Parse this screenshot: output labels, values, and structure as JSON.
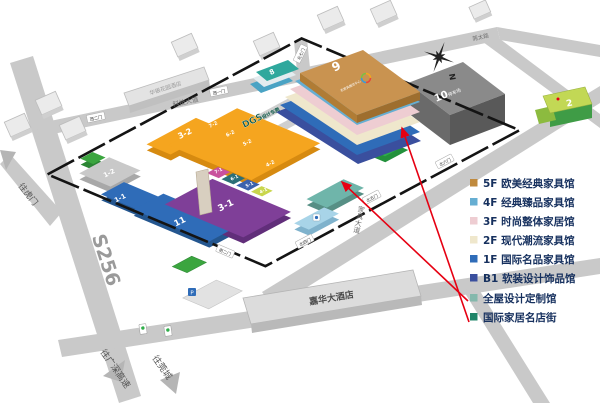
{
  "legend": {
    "items": [
      {
        "label": "5F 欧美经典家具馆",
        "color": "#c08a3e"
      },
      {
        "label": "4F 经典臻品家具馆",
        "color": "#66aed2"
      },
      {
        "label": "3F 时尚整体家居馆",
        "color": "#eecdd2"
      },
      {
        "label": "2F 现代潮流家具馆",
        "color": "#efe7cc"
      },
      {
        "label": "1F 国际名品家具馆",
        "color": "#2f6cb8"
      },
      {
        "label": "B1 软装设计饰品馆",
        "color": "#3a4f9e"
      },
      {
        "label": "全屋设计定制馆",
        "color": "#84b8ac"
      },
      {
        "label": "国际家居名店街",
        "color": "#1f8468"
      }
    ]
  },
  "roads": {
    "s256": "S256",
    "top_road": "科技大道",
    "top_right_road": "莞太路",
    "furniture_avenue": "家具大道"
  },
  "directions": {
    "to_humen": "往虎门",
    "to_expressway": "往广深高速",
    "to_guancheng": "往莞城"
  },
  "gates": {
    "west2": "西二门",
    "west1": "西一门",
    "north7": "北七门",
    "north6": "北六门",
    "north5": "北五门",
    "north4": "北四门",
    "south2": "南二门"
  },
  "compass": {
    "north": "N"
  },
  "buildings": {
    "b9": "9",
    "b9_logo_text": "名家具展览中心",
    "b10": "10",
    "b10_sub": "停车场",
    "b8": "8",
    "b2": "2",
    "b11": "11",
    "b1_1": "1-1",
    "b1_2": "1-2",
    "b3_1": "3-1",
    "b3_2": "3-2",
    "b4_1": "4-1",
    "b5_1": "5-1",
    "b6_1": "6-1",
    "b7_1": "7-1",
    "b4_2": "4-2",
    "b5_2": "5-2",
    "b6_2": "6-2",
    "b7_2": "7-2",
    "dgs_logo": "DGS",
    "dgs_name": "设计东莞",
    "jiahua_hotel": "嘉华大酒店",
    "huayin_hotel": "华银花园酒店",
    "parking": "P"
  },
  "colors": {
    "road": "#c9c9c9",
    "boundary": "#141414",
    "arrow": "#e60012"
  }
}
